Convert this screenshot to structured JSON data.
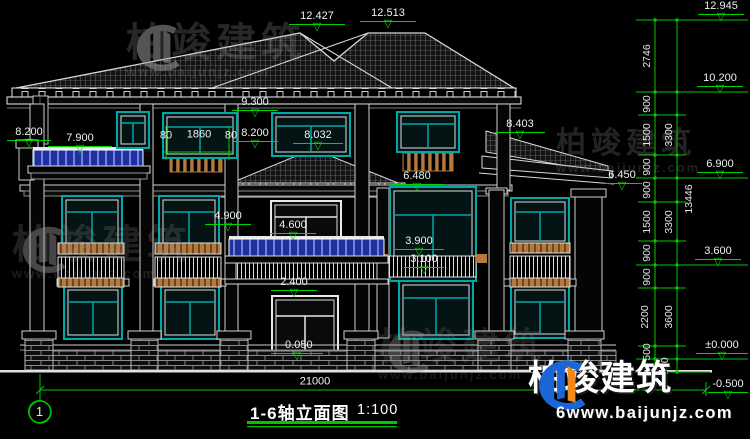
{
  "title_block": {
    "axis_bubble": "1",
    "drawing_title": "1-6轴立面图",
    "drawing_scale": "1:100"
  },
  "levels": [
    {
      "t": "12.427",
      "x": 317,
      "y": 17,
      "w": 56
    },
    {
      "t": "12.513",
      "x": 388,
      "y": 14,
      "w": 56
    },
    {
      "t": "12.945",
      "x": 721,
      "y": 7,
      "w": 46
    },
    {
      "t": "10.200",
      "x": 720,
      "y": 79,
      "w": 46
    },
    {
      "t": "9.300",
      "x": 255,
      "y": 103,
      "w": 46
    },
    {
      "t": "8.200",
      "x": 29,
      "y": 133,
      "w": 44
    },
    {
      "t": "7.900",
      "x": 80,
      "y": 139,
      "w": 64
    },
    {
      "t": "8.200",
      "x": 255,
      "y": 134,
      "w": 46
    },
    {
      "t": "8.032",
      "x": 318,
      "y": 136,
      "w": 50
    },
    {
      "t": "8.403",
      "x": 520,
      "y": 125,
      "w": 50
    },
    {
      "t": "6.480",
      "x": 417,
      "y": 177,
      "w": 52
    },
    {
      "t": "6.450",
      "x": 622,
      "y": 176,
      "w": 40
    },
    {
      "t": "6.900",
      "x": 720,
      "y": 165,
      "w": 46
    },
    {
      "t": "4.900",
      "x": 228,
      "y": 217,
      "w": 46
    },
    {
      "t": "4.600",
      "x": 293,
      "y": 226,
      "w": 46
    },
    {
      "t": "3.900",
      "x": 419,
      "y": 242,
      "w": 50
    },
    {
      "t": "3.100",
      "x": 424,
      "y": 260,
      "w": 40
    },
    {
      "t": "2.400",
      "x": 294,
      "y": 283,
      "w": 46
    },
    {
      "t": "-0.050",
      "x": 297,
      "y": 346,
      "w": 52
    },
    {
      "t": "3.600",
      "x": 718,
      "y": 252,
      "w": 46
    },
    {
      "t": "±0.000",
      "x": 722,
      "y": 346,
      "w": 52
    },
    {
      "t": "-0.500",
      "x": 728,
      "y": 385,
      "w": 40
    }
  ],
  "h_dims": [
    {
      "t": "80",
      "x": 166,
      "y": 136
    },
    {
      "t": "1860",
      "x": 199,
      "y": 135
    },
    {
      "t": "80",
      "x": 231,
      "y": 136
    },
    {
      "t": "21000",
      "x": 315,
      "y": 382
    }
  ],
  "v_dims": [
    {
      "t": "2746",
      "x": 647,
      "y": 56
    },
    {
      "t": "900",
      "x": 647,
      "y": 104
    },
    {
      "t": "1500",
      "x": 647,
      "y": 135
    },
    {
      "t": "900",
      "x": 647,
      "y": 167
    },
    {
      "t": "900",
      "x": 647,
      "y": 190
    },
    {
      "t": "1500",
      "x": 647,
      "y": 222
    },
    {
      "t": "900",
      "x": 647,
      "y": 253
    },
    {
      "t": "900",
      "x": 647,
      "y": 277
    },
    {
      "t": "2200",
      "x": 645,
      "y": 317
    },
    {
      "t": "500",
      "x": 647,
      "y": 352
    },
    {
      "t": "500",
      "x": 665,
      "y": 366
    },
    {
      "t": "3300",
      "x": 669,
      "y": 135
    },
    {
      "t": "3300",
      "x": 669,
      "y": 222
    },
    {
      "t": "3600",
      "x": 669,
      "y": 317
    },
    {
      "t": "13446",
      "x": 689,
      "y": 199
    }
  ],
  "watermarks": [
    {
      "brand": "柏竣建筑",
      "url": "www.baijunjz.com",
      "x": 126,
      "y": 22,
      "size": 40,
      "logo": true,
      "opacity": 0.55
    },
    {
      "brand": "柏竣建筑",
      "url": "www.baijunjz.com",
      "x": 556,
      "y": 128,
      "size": 30,
      "logo": false,
      "opacity": 0.5
    },
    {
      "brand": "柏竣建筑",
      "url": "www.baijunjz.com",
      "x": 12,
      "y": 224,
      "size": 40,
      "logo": true,
      "opacity": 0.45
    },
    {
      "brand": "柏竣建筑",
      "url": "www.baijunjz.com",
      "x": 378,
      "y": 328,
      "size": 37,
      "logo": true,
      "opacity": 0.38
    }
  ],
  "logo": {
    "brand": "柏竣建筑",
    "url": "6www.baijunjz.com"
  },
  "colors": {
    "dimension_green": "#00d400",
    "line_white": "#e8e8e8",
    "window_teal": "#00a8a8",
    "railing_blue": "#22309e",
    "railing_wood": "#b5793c"
  }
}
